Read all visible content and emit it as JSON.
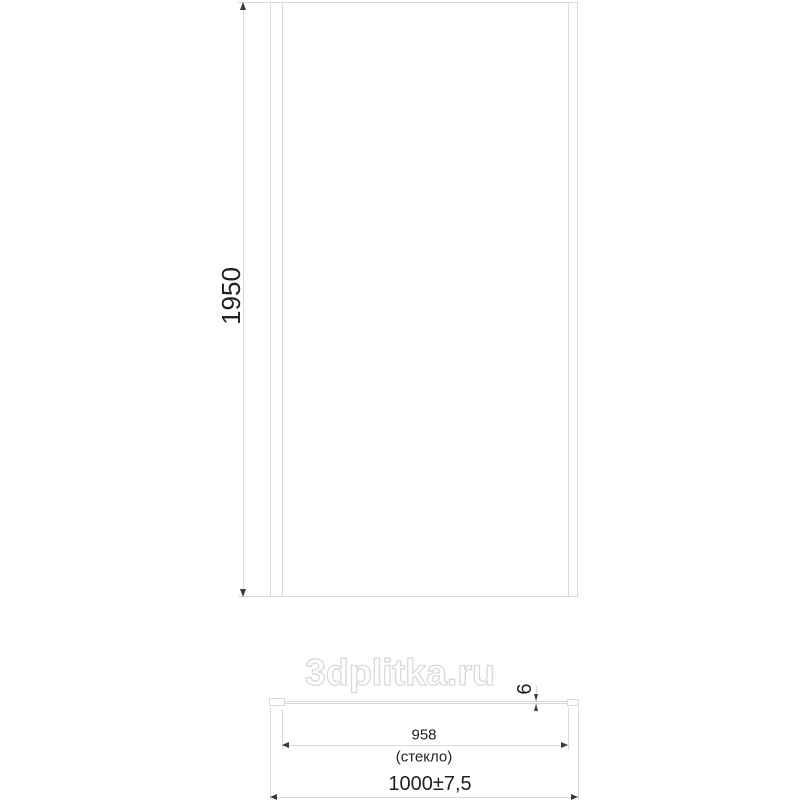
{
  "watermark": {
    "text": "3dplitka.ru"
  },
  "front_view": {
    "height_label": "1950"
  },
  "bottom_view": {
    "glass_width_label": "958",
    "glass_width_note": "(стекло)",
    "overall_width_label": "1000±7,5",
    "thickness_label": "6"
  },
  "colors": {
    "line": "#d9d9d9",
    "ink": "#222222",
    "arrow": "#3a3a3a",
    "watermark_outline": "#d9d9d9"
  }
}
